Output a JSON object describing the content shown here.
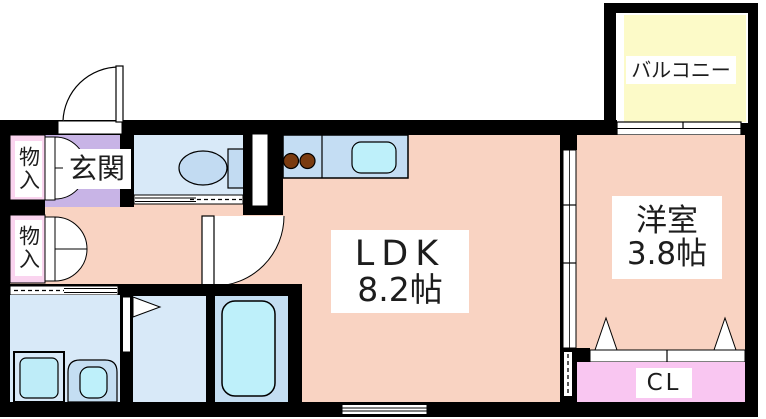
{
  "plan": {
    "title": "apartment floor plan",
    "labels": {
      "ldk_name": "LDK",
      "ldk_size": "8.2帖",
      "western_name": "洋室",
      "western_size": "3.8帖",
      "balcony": "バルコニー",
      "closet": "CL",
      "entrance": "玄関",
      "storage": "物入"
    },
    "rooms": [
      {
        "id": "ldk",
        "name": "LDK",
        "size_tatami": 8.2
      },
      {
        "id": "western-room",
        "name": "洋室",
        "size_tatami": 3.8
      },
      {
        "id": "balcony",
        "name": "バルコニー"
      },
      {
        "id": "closet",
        "name": "CL"
      },
      {
        "id": "entrance",
        "name": "玄関"
      },
      {
        "id": "storage-upper",
        "name": "物入"
      },
      {
        "id": "storage-lower",
        "name": "物入"
      },
      {
        "id": "toilet-room"
      },
      {
        "id": "washroom"
      },
      {
        "id": "dressing-room"
      },
      {
        "id": "bathroom"
      }
    ],
    "icons": [
      "toilet-icon",
      "stove-burners-icon",
      "kitchen-sink-icon",
      "bathtub-icon",
      "washing-machine-icon",
      "vanity-sink-icon",
      "entrance-door",
      "storage-double-doors",
      "ldk-door",
      "folding-door",
      "sliding-doors",
      "windows"
    ],
    "colors": {
      "wall": "#000000",
      "floor_main": "#F9D3C2",
      "entrance": "#C8B4E6",
      "storage": "#FAD4EF",
      "closet": "#F9C6F1",
      "wet_room": "#D8E9F8",
      "bath": "#C4DEF2",
      "counter": "#C4DDF3",
      "water_fixture": "#BEF0FA",
      "toilet_fixture": "#C2DBF2",
      "balcony": "#FCFAC8",
      "burner": "#7A3B10",
      "label_bg": "#FFFFFF",
      "text": "#1D1D1D"
    }
  }
}
